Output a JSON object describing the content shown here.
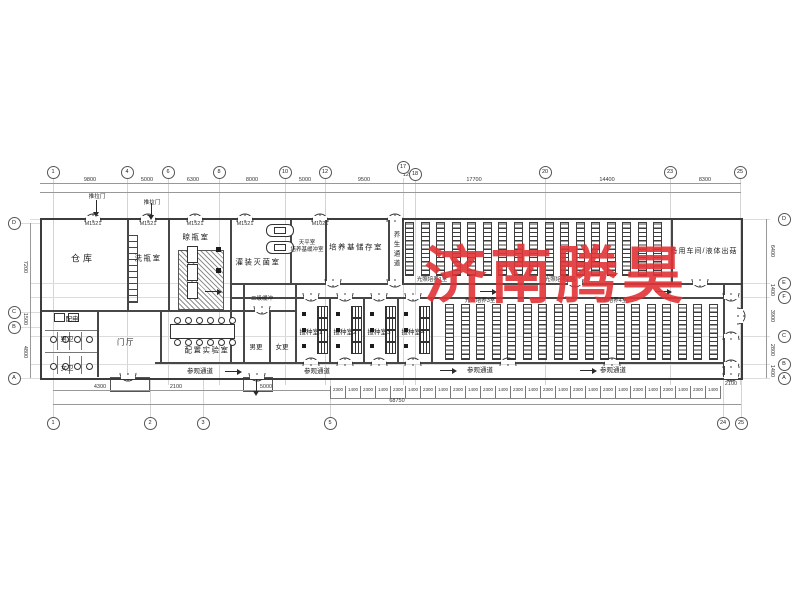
{
  "watermark": {
    "text": "济南腾昊",
    "color": "#e23437"
  },
  "labels": [
    {
      "t": "仓库",
      "x": 83,
      "y": 258,
      "c": "n8"
    },
    {
      "t": "洗瓶室",
      "x": 148,
      "y": 258,
      "c": "n7"
    },
    {
      "t": "晾瓶室",
      "x": 196,
      "y": 237,
      "c": "n7"
    },
    {
      "t": "灌装灭菌室",
      "x": 258,
      "y": 262,
      "c": "n7"
    },
    {
      "t": "天平室",
      "x": 307,
      "y": 242,
      "c": "t5"
    },
    {
      "t": "培养基缓冲室",
      "x": 307,
      "y": 249,
      "c": "t5"
    },
    {
      "t": "培养基储存室",
      "x": 356,
      "y": 247,
      "c": "n7"
    },
    {
      "t": "养生通道",
      "x": 395,
      "y": 250,
      "c": "v6"
    },
    {
      "t": "备用车间/液体出菇",
      "x": 704,
      "y": 251,
      "c": "n6"
    },
    {
      "t": "二级缓冲",
      "x": 262,
      "y": 298,
      "c": "t5"
    },
    {
      "t": "男更",
      "x": 256,
      "y": 346,
      "c": "t6"
    },
    {
      "t": "女更",
      "x": 282,
      "y": 346,
      "c": "t6"
    },
    {
      "t": "接种室1",
      "x": 311,
      "y": 331,
      "c": "t6"
    },
    {
      "t": "接种室2",
      "x": 345,
      "y": 331,
      "c": "t6"
    },
    {
      "t": "接种室3",
      "x": 379,
      "y": 331,
      "c": "t6"
    },
    {
      "t": "接种室4",
      "x": 413,
      "y": 331,
      "c": "t6"
    },
    {
      "t": "配电",
      "x": 72,
      "y": 318,
      "c": "t6"
    },
    {
      "t": "男卫",
      "x": 67,
      "y": 338,
      "c": "t6"
    },
    {
      "t": "女卫",
      "x": 67,
      "y": 367,
      "c": "t6"
    },
    {
      "t": "门厅",
      "x": 126,
      "y": 342,
      "c": "n7"
    },
    {
      "t": "配置实验室",
      "x": 207,
      "y": 350,
      "c": "n7"
    },
    {
      "t": "参观通道",
      "x": 200,
      "y": 370,
      "c": "t6"
    },
    {
      "t": "参观通道",
      "x": 317,
      "y": 370,
      "c": "t6"
    },
    {
      "t": "参观通道",
      "x": 480,
      "y": 369,
      "c": "t6"
    },
    {
      "t": "参观通道",
      "x": 613,
      "y": 369,
      "c": "t6"
    },
    {
      "t": "光照培养1室",
      "x": 432,
      "y": 279,
      "c": "t5"
    },
    {
      "t": "光照培养2室",
      "x": 560,
      "y": 279,
      "c": "t5"
    },
    {
      "t": "光照培养3室",
      "x": 480,
      "y": 300,
      "c": "t5"
    },
    {
      "t": "光照培养4室",
      "x": 612,
      "y": 300,
      "c": "t5"
    },
    {
      "t": "推拉门",
      "x": 97,
      "y": 196,
      "c": "t5"
    },
    {
      "t": "推拉门",
      "x": 152,
      "y": 202,
      "c": "t5"
    },
    {
      "t": "M1521",
      "x": 93,
      "y": 224,
      "c": "d"
    },
    {
      "t": "M1521",
      "x": 148,
      "y": 224,
      "c": "d"
    },
    {
      "t": "M1521",
      "x": 195,
      "y": 224,
      "c": "d"
    },
    {
      "t": "M1521",
      "x": 245,
      "y": 224,
      "c": "d"
    },
    {
      "t": "M1021",
      "x": 320,
      "y": 224,
      "c": "d"
    },
    {
      "t": "9800",
      "x": 90,
      "y": 180,
      "c": "d"
    },
    {
      "t": "5000",
      "x": 147,
      "y": 180,
      "c": "d"
    },
    {
      "t": "6300",
      "x": 193,
      "y": 180,
      "c": "d"
    },
    {
      "t": "8000",
      "x": 252,
      "y": 180,
      "c": "d"
    },
    {
      "t": "5000",
      "x": 305,
      "y": 180,
      "c": "d"
    },
    {
      "t": "9500",
      "x": 364,
      "y": 180,
      "c": "d"
    },
    {
      "t": "1200",
      "x": 409,
      "y": 175,
      "c": "d"
    },
    {
      "t": "17700",
      "x": 474,
      "y": 180,
      "c": "d"
    },
    {
      "t": "14400",
      "x": 607,
      "y": 180,
      "c": "d"
    },
    {
      "t": "8300",
      "x": 705,
      "y": 180,
      "c": "d"
    },
    {
      "t": "7200",
      "x": 25,
      "y": 267,
      "c": "dv"
    },
    {
      "t": "1500",
      "x": 25,
      "y": 319,
      "c": "dv"
    },
    {
      "t": "4800",
      "x": 25,
      "y": 352,
      "c": "dv"
    },
    {
      "t": "6400",
      "x": 772,
      "y": 251,
      "c": "dv"
    },
    {
      "t": "1400",
      "x": 772,
      "y": 290,
      "c": "dv"
    },
    {
      "t": "3900",
      "x": 772,
      "y": 316,
      "c": "dv"
    },
    {
      "t": "2800",
      "x": 772,
      "y": 350,
      "c": "dv"
    },
    {
      "t": "1400",
      "x": 772,
      "y": 371,
      "c": "dv"
    },
    {
      "t": "4300",
      "x": 100,
      "y": 387,
      "c": "d"
    },
    {
      "t": "2100",
      "x": 176,
      "y": 387,
      "c": "d"
    },
    {
      "t": "5000",
      "x": 266,
      "y": 387,
      "c": "d"
    },
    {
      "t": "2100",
      "x": 731,
      "y": 384,
      "c": "d"
    },
    {
      "t": "68750",
      "x": 397,
      "y": 401,
      "c": "d"
    }
  ],
  "bubbles": [
    {
      "label": "1",
      "x": 53,
      "y": 172,
      "s": "t"
    },
    {
      "label": "4",
      "x": 127,
      "y": 172,
      "s": "t"
    },
    {
      "label": "6",
      "x": 168,
      "y": 172,
      "s": "t"
    },
    {
      "label": "8",
      "x": 219,
      "y": 172,
      "s": "t"
    },
    {
      "label": "10",
      "x": 285,
      "y": 172,
      "s": "t"
    },
    {
      "label": "12",
      "x": 325,
      "y": 172,
      "s": "t"
    },
    {
      "label": "17",
      "x": 403,
      "y": 167,
      "s": "t"
    },
    {
      "label": "18",
      "x": 415,
      "y": 174,
      "s": "t"
    },
    {
      "label": "20",
      "x": 545,
      "y": 172,
      "s": "t"
    },
    {
      "label": "23",
      "x": 670,
      "y": 172,
      "s": "t"
    },
    {
      "label": "25",
      "x": 740,
      "y": 172,
      "s": "t"
    },
    {
      "label": "1",
      "x": 53,
      "y": 423,
      "s": "b"
    },
    {
      "label": "2",
      "x": 150,
      "y": 423,
      "s": "b"
    },
    {
      "label": "3",
      "x": 203,
      "y": 423,
      "s": "b"
    },
    {
      "label": "5",
      "x": 330,
      "y": 423,
      "s": "b"
    },
    {
      "label": "24",
      "x": 723,
      "y": 423,
      "s": "b"
    },
    {
      "label": "25",
      "x": 741,
      "y": 423,
      "s": "b"
    },
    {
      "label": "D",
      "x": 14,
      "y": 223,
      "s": "l"
    },
    {
      "label": "C",
      "x": 14,
      "y": 312,
      "s": "l"
    },
    {
      "label": "B",
      "x": 14,
      "y": 327,
      "s": "l"
    },
    {
      "label": "A",
      "x": 14,
      "y": 378,
      "s": "l"
    },
    {
      "label": "D",
      "x": 784,
      "y": 219,
      "s": "r"
    },
    {
      "label": "E",
      "x": 784,
      "y": 283,
      "s": "r"
    },
    {
      "label": "F",
      "x": 784,
      "y": 297,
      "s": "r"
    },
    {
      "label": "C",
      "x": 784,
      "y": 336,
      "s": "r"
    },
    {
      "label": "B",
      "x": 784,
      "y": 364,
      "s": "r"
    },
    {
      "label": "A",
      "x": 784,
      "y": 378,
      "s": "r"
    }
  ],
  "shapes": [
    {
      "c": "w2",
      "x": 127,
      "y": 218,
      "w": 1.5,
      "h": 92
    },
    {
      "c": "w2",
      "x": 168,
      "y": 218,
      "w": 1.5,
      "h": 92
    },
    {
      "c": "w2",
      "x": 230,
      "y": 218,
      "w": 1.5,
      "h": 145
    },
    {
      "c": "w2",
      "x": 290,
      "y": 218,
      "w": 1.5,
      "h": 65
    },
    {
      "c": "w2",
      "x": 325,
      "y": 218,
      "w": 1.5,
      "h": 65
    },
    {
      "c": "w2",
      "x": 388,
      "y": 218,
      "w": 1.5,
      "h": 65
    },
    {
      "c": "w2",
      "x": 402,
      "y": 218,
      "w": 1.5,
      "h": 65
    },
    {
      "c": "w2",
      "x": 671,
      "y": 218,
      "w": 1.5,
      "h": 65
    },
    {
      "c": "w2",
      "x": 723,
      "y": 283,
      "w": 1.5,
      "h": 94
    },
    {
      "c": "w2",
      "x": 97,
      "y": 310,
      "w": 1.5,
      "h": 67
    },
    {
      "c": "w2",
      "x": 160,
      "y": 310,
      "w": 1.5,
      "h": 52
    },
    {
      "c": "w2",
      "x": 243,
      "y": 283,
      "w": 1.5,
      "h": 79
    },
    {
      "c": "w2",
      "x": 269,
      "y": 310,
      "w": 1.5,
      "h": 52
    },
    {
      "c": "w2",
      "x": 295,
      "y": 283,
      "w": 1.5,
      "h": 79
    },
    {
      "c": "w2",
      "x": 329,
      "y": 297,
      "w": 1.5,
      "h": 65
    },
    {
      "c": "w2",
      "x": 363,
      "y": 297,
      "w": 1.5,
      "h": 65
    },
    {
      "c": "w2",
      "x": 397,
      "y": 297,
      "w": 1.5,
      "h": 65
    },
    {
      "c": "w2",
      "x": 431,
      "y": 297,
      "w": 1.5,
      "h": 65
    },
    {
      "c": "w2",
      "x": 40,
      "y": 310,
      "w": 255,
      "h": 1.5
    },
    {
      "c": "w1",
      "x": 45,
      "y": 330,
      "w": 52,
      "h": 1.2
    },
    {
      "c": "w1",
      "x": 45,
      "y": 352,
      "w": 52,
      "h": 1.2
    },
    {
      "c": "w2",
      "x": 230,
      "y": 283,
      "w": 511,
      "h": 1.5
    },
    {
      "c": "w2",
      "x": 230,
      "y": 297,
      "w": 493,
      "h": 1.5
    },
    {
      "c": "w2",
      "x": 155,
      "y": 362,
      "w": 568,
      "h": 1.5
    },
    {
      "c": "w1",
      "x": 57,
      "y": 332,
      "w": 1,
      "h": 18
    },
    {
      "c": "w1",
      "x": 69,
      "y": 332,
      "w": 1,
      "h": 18
    },
    {
      "c": "w1",
      "x": 81,
      "y": 332,
      "w": 1,
      "h": 18
    },
    {
      "c": "w1",
      "x": 57,
      "y": 356,
      "w": 1,
      "h": 18
    },
    {
      "c": "w1",
      "x": 69,
      "y": 356,
      "w": 1,
      "h": 18
    },
    {
      "c": "w1",
      "x": 81,
      "y": 356,
      "w": 1,
      "h": 18
    },
    {
      "c": "pr",
      "x": 110,
      "y": 377,
      "w": 38,
      "h": 13
    },
    {
      "c": "pr",
      "x": 243,
      "y": 377,
      "w": 28,
      "h": 13
    },
    {
      "c": "dl",
      "x": 40,
      "y": 183,
      "w": 701,
      "h": 1
    },
    {
      "c": "dl",
      "x": 40,
      "y": 192,
      "w": 701,
      "h": 1
    },
    {
      "c": "dl",
      "x": 53,
      "y": 390,
      "w": 277,
      "h": 1
    },
    {
      "c": "dl",
      "x": 53,
      "y": 404,
      "w": 688,
      "h": 1
    },
    {
      "c": "dl",
      "x": 30,
      "y": 223,
      "w": 1,
      "h": 155
    },
    {
      "c": "dl",
      "x": 766,
      "y": 219,
      "w": 1,
      "h": 159
    },
    {
      "c": "gl",
      "x": 20,
      "y": 312,
      "w": 22,
      "h": 1
    },
    {
      "c": "gl",
      "x": 20,
      "y": 327,
      "w": 22,
      "h": 1
    },
    {
      "c": "ladder",
      "x": 127,
      "y": 235,
      "w": 9,
      "h": 66
    },
    {
      "c": "hatch",
      "x": 178,
      "y": 250,
      "w": 44,
      "h": 58
    },
    {
      "c": "eq",
      "x": 187,
      "y": 246,
      "w": 9,
      "h": 15
    },
    {
      "c": "eq",
      "x": 187,
      "y": 264,
      "w": 9,
      "h": 15
    },
    {
      "c": "eq",
      "x": 187,
      "y": 282,
      "w": 9,
      "h": 15
    },
    {
      "c": "eq",
      "x": 170,
      "y": 324,
      "w": 63,
      "h": 13
    },
    {
      "c": "blk",
      "x": 216,
      "y": 247,
      "w": 5,
      "h": 5
    },
    {
      "c": "blk",
      "x": 216,
      "y": 268,
      "w": 5,
      "h": 5
    },
    {
      "c": "capsule",
      "x": 266,
      "y": 224,
      "w": 26,
      "h": 11
    },
    {
      "c": "capsule",
      "x": 266,
      "y": 241,
      "w": 26,
      "h": 11
    },
    {
      "c": "eq",
      "x": 54,
      "y": 313,
      "w": 9,
      "h": 7
    },
    {
      "c": "eq",
      "x": 68,
      "y": 313,
      "w": 9,
      "h": 7
    },
    {
      "c": "dot",
      "x": 50,
      "y": 336,
      "w": 5,
      "h": 5
    },
    {
      "c": "dot",
      "x": 62,
      "y": 336,
      "w": 5,
      "h": 5
    },
    {
      "c": "dot",
      "x": 74,
      "y": 336,
      "w": 5,
      "h": 5
    },
    {
      "c": "dot",
      "x": 86,
      "y": 336,
      "w": 5,
      "h": 5
    },
    {
      "c": "dot",
      "x": 50,
      "y": 363,
      "w": 5,
      "h": 5
    },
    {
      "c": "dot",
      "x": 62,
      "y": 363,
      "w": 5,
      "h": 5
    },
    {
      "c": "dot",
      "x": 74,
      "y": 363,
      "w": 5,
      "h": 5
    },
    {
      "c": "dot",
      "x": 86,
      "y": 363,
      "w": 5,
      "h": 5
    },
    {
      "c": "dot",
      "x": 174,
      "y": 317,
      "w": 5,
      "h": 5
    },
    {
      "c": "dot",
      "x": 185,
      "y": 317,
      "w": 5,
      "h": 5
    },
    {
      "c": "dot",
      "x": 196,
      "y": 317,
      "w": 5,
      "h": 5
    },
    {
      "c": "dot",
      "x": 207,
      "y": 317,
      "w": 5,
      "h": 5
    },
    {
      "c": "dot",
      "x": 218,
      "y": 317,
      "w": 5,
      "h": 5
    },
    {
      "c": "dot",
      "x": 229,
      "y": 317,
      "w": 5,
      "h": 5
    },
    {
      "c": "dot",
      "x": 174,
      "y": 339,
      "w": 5,
      "h": 5
    },
    {
      "c": "dot",
      "x": 185,
      "y": 339,
      "w": 5,
      "h": 5
    },
    {
      "c": "dot",
      "x": 196,
      "y": 339,
      "w": 5,
      "h": 5
    },
    {
      "c": "dot",
      "x": 207,
      "y": 339,
      "w": 5,
      "h": 5
    },
    {
      "c": "dot",
      "x": 218,
      "y": 339,
      "w": 5,
      "h": 5
    },
    {
      "c": "dot",
      "x": 229,
      "y": 339,
      "w": 5,
      "h": 5
    }
  ],
  "doors": [
    {
      "x": 84,
      "y": 209,
      "r": ""
    },
    {
      "x": 139,
      "y": 209,
      "r": ""
    },
    {
      "x": 186,
      "y": 209,
      "r": ""
    },
    {
      "x": 236,
      "y": 209,
      "r": ""
    },
    {
      "x": 311,
      "y": 209,
      "r": ""
    },
    {
      "x": 386,
      "y": 209,
      "r": ""
    },
    {
      "x": 302,
      "y": 353,
      "r": ""
    },
    {
      "x": 336,
      "y": 353,
      "r": ""
    },
    {
      "x": 370,
      "y": 353,
      "r": ""
    },
    {
      "x": 404,
      "y": 353,
      "r": ""
    },
    {
      "x": 499,
      "y": 353,
      "r": ""
    },
    {
      "x": 603,
      "y": 353,
      "r": ""
    },
    {
      "x": 722,
      "y": 327,
      "r": ""
    },
    {
      "x": 722,
      "y": 355,
      "r": ""
    },
    {
      "x": 324,
      "y": 274,
      "r": "r180"
    },
    {
      "x": 386,
      "y": 274,
      "r": "r180"
    },
    {
      "x": 566,
      "y": 274,
      "r": "r180"
    },
    {
      "x": 691,
      "y": 274,
      "r": "r180"
    },
    {
      "x": 302,
      "y": 288,
      "r": "r180"
    },
    {
      "x": 336,
      "y": 288,
      "r": "r180"
    },
    {
      "x": 370,
      "y": 288,
      "r": "r180"
    },
    {
      "x": 404,
      "y": 288,
      "r": "r180"
    },
    {
      "x": 253,
      "y": 301,
      "r": "r180"
    },
    {
      "x": 119,
      "y": 368,
      "r": "r180"
    },
    {
      "x": 248,
      "y": 368,
      "r": "r180"
    },
    {
      "x": 722,
      "y": 368,
      "r": "r180"
    },
    {
      "x": 722,
      "y": 288,
      "r": "r180"
    },
    {
      "x": 732,
      "y": 307,
      "r": "r90"
    }
  ],
  "arrows": [
    {
      "x": 205,
      "y": 291,
      "r": ""
    },
    {
      "x": 480,
      "y": 291,
      "r": ""
    },
    {
      "x": 655,
      "y": 291,
      "r": ""
    },
    {
      "x": 225,
      "y": 371,
      "r": ""
    },
    {
      "x": 440,
      "y": 370,
      "r": ""
    },
    {
      "x": 580,
      "y": 370,
      "r": ""
    },
    {
      "x": 90,
      "y": 206,
      "r": "a90"
    },
    {
      "x": 145,
      "y": 209,
      "r": "a90"
    },
    {
      "x": 250,
      "y": 385,
      "r": "a90"
    }
  ],
  "small_dims": [
    {
      "v": "2300"
    },
    {
      "v": "1400"
    },
    {
      "v": "2300"
    },
    {
      "v": "1400"
    },
    {
      "v": "2300"
    },
    {
      "v": "1400"
    },
    {
      "v": "2300"
    },
    {
      "v": "1400"
    },
    {
      "v": "2300"
    },
    {
      "v": "1400"
    },
    {
      "v": "2300"
    },
    {
      "v": "1400"
    },
    {
      "v": "2300"
    },
    {
      "v": "1400"
    },
    {
      "v": "2300"
    },
    {
      "v": "1400"
    },
    {
      "v": "2300"
    },
    {
      "v": "1400"
    },
    {
      "v": "2300"
    },
    {
      "v": "1400"
    },
    {
      "v": "2300"
    },
    {
      "v": "1400"
    },
    {
      "v": "2300"
    },
    {
      "v": "1400"
    },
    {
      "v": "2300"
    },
    {
      "v": "1400"
    }
  ],
  "racks": {
    "zones": [
      {
        "x": 405,
        "y": 222,
        "w": 264,
        "h": 52,
        "pitch": 15.5,
        "sw": 7
      },
      {
        "x": 445,
        "y": 304,
        "w": 276,
        "h": 54,
        "pitch": 15.5,
        "sw": 7
      }
    ]
  },
  "inoculation": {
    "xs": [
      295,
      329,
      363,
      397
    ]
  }
}
